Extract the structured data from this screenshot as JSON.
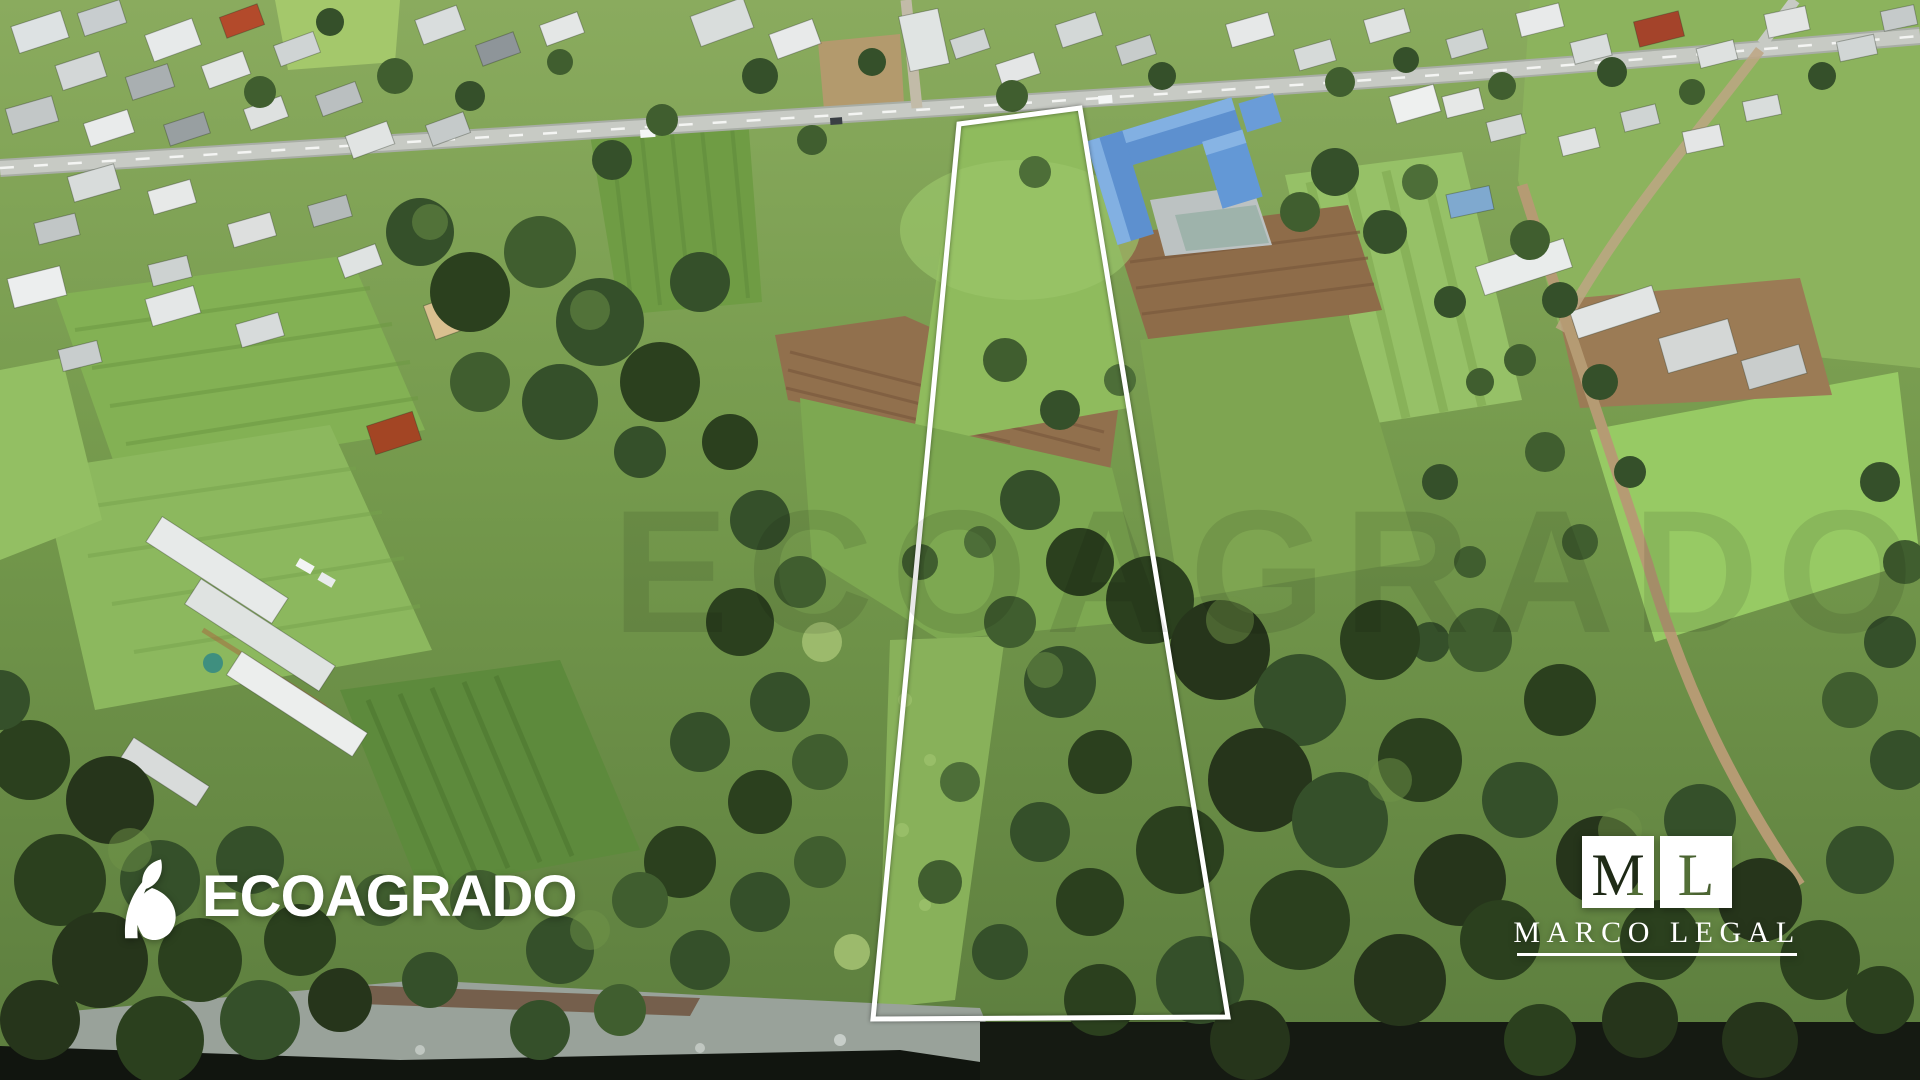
{
  "image": {
    "type": "aerial-drone-photograph",
    "subject": "Rural land parcel for sale outlined in white, bordered by a town, farm fields, a blue-roofed school building and a tree-lined river bank",
    "width_px": 1920,
    "height_px": 1080
  },
  "property_outline": {
    "shape": "quadrilateral",
    "points": "959,124 1080,108 1228,1017 873,1019",
    "stroke_color": "#ffffff",
    "stroke_width": 5
  },
  "watermark": {
    "text": "ECOAGRADO",
    "opacity": 0.09
  },
  "branding": {
    "ecoagrado": {
      "logo_text": "ECOAGRADO",
      "icon": "leaf-icon",
      "color": "#ffffff"
    },
    "marco_legal": {
      "monogram_left": "M",
      "monogram_right": "L",
      "wordmark": "MARCO LEGAL",
      "color": "#ffffff"
    }
  },
  "scene": {
    "palette": {
      "field_green": "#7ca254",
      "bright_field_green": "#97ca64",
      "pasture_green": "#8fbb5d",
      "tree_dark_green": "#2b401e",
      "plowed_brown": "#8e6c49",
      "road_gray": "#c7cac4",
      "dirt_road_tan": "#b59b73",
      "school_roof_blue": "#5d90cf",
      "river_dark": "#11150f",
      "rock_gray": "#99a29a",
      "roof_white": "#e8eaea",
      "roof_red": "#a4432a"
    }
  }
}
